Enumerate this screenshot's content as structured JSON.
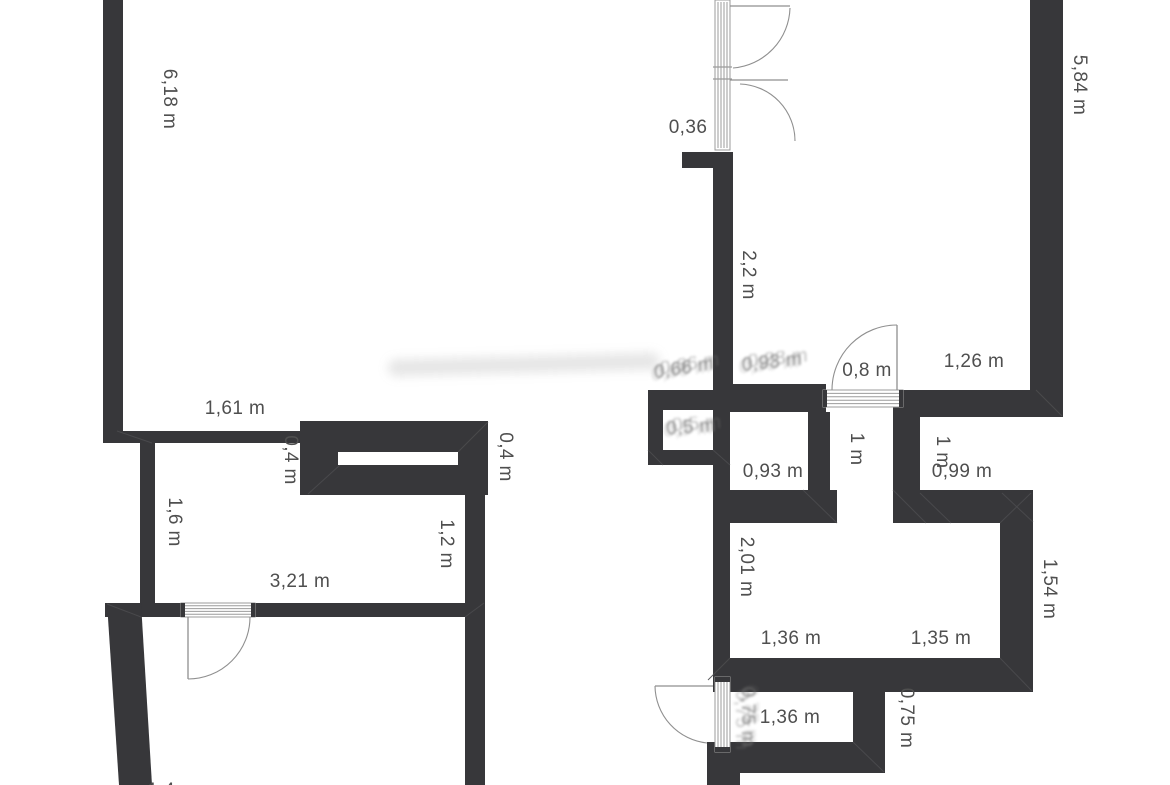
{
  "page": {
    "description": "Black-and-white architectural floor plan with dimension annotations",
    "units": "m"
  },
  "colors": {
    "background": "#ffffff",
    "wall": "#37373a",
    "label": "#4f4f4f",
    "door_line": "#8f8f8f",
    "threshold_stripe": "#9b9b9b",
    "mitre_line": "#4b4b4e"
  },
  "dimension_labels": [
    {
      "text": "6,18 m",
      "x": 169,
      "y": 99,
      "rotated": true,
      "ghost": false,
      "tilt": 0
    },
    {
      "text": "5,84 m",
      "x": 1079,
      "y": 85,
      "rotated": true,
      "ghost": false,
      "tilt": 0
    },
    {
      "text": "0,36",
      "x": 688,
      "y": 128,
      "rotated": false,
      "ghost": false,
      "tilt": 0
    },
    {
      "text": "2,2 m",
      "x": 748,
      "y": 275,
      "rotated": true,
      "ghost": false,
      "tilt": 0
    },
    {
      "text": "0,8 m",
      "x": 867,
      "y": 371,
      "rotated": false,
      "ghost": false,
      "tilt": 0
    },
    {
      "text": "1,26 m",
      "x": 974,
      "y": 362,
      "rotated": false,
      "ghost": false,
      "tilt": 0
    },
    {
      "text": "1,61 m",
      "x": 235,
      "y": 409,
      "rotated": false,
      "ghost": false,
      "tilt": 0
    },
    {
      "text": "0,4 m",
      "x": 290,
      "y": 460,
      "rotated": true,
      "ghost": false,
      "tilt": 0
    },
    {
      "text": "0,4 m",
      "x": 505,
      "y": 457,
      "rotated": true,
      "ghost": false,
      "tilt": 0
    },
    {
      "text": "1,6 m",
      "x": 174,
      "y": 522,
      "rotated": true,
      "ghost": false,
      "tilt": 0
    },
    {
      "text": "1,2 m",
      "x": 446,
      "y": 544,
      "rotated": true,
      "ghost": false,
      "tilt": 0
    },
    {
      "text": "3,21 m",
      "x": 300,
      "y": 582,
      "rotated": false,
      "ghost": false,
      "tilt": 0
    },
    {
      "text": "0,93 m",
      "x": 773,
      "y": 472,
      "rotated": false,
      "ghost": false,
      "tilt": 0
    },
    {
      "text": "1 m",
      "x": 856,
      "y": 449,
      "rotated": true,
      "ghost": false,
      "tilt": 0
    },
    {
      "text": "1 m",
      "x": 942,
      "y": 452,
      "rotated": true,
      "ghost": false,
      "tilt": 0
    },
    {
      "text": "0,99 m",
      "x": 962,
      "y": 472,
      "rotated": false,
      "ghost": false,
      "tilt": 0
    },
    {
      "text": "2,01 m",
      "x": 746,
      "y": 567,
      "rotated": true,
      "ghost": false,
      "tilt": 0
    },
    {
      "text": "1,54 m",
      "x": 1049,
      "y": 589,
      "rotated": true,
      "ghost": false,
      "tilt": 0
    },
    {
      "text": "1,36 m",
      "x": 791,
      "y": 639,
      "rotated": false,
      "ghost": false,
      "tilt": 0
    },
    {
      "text": "1,35 m",
      "x": 941,
      "y": 639,
      "rotated": false,
      "ghost": false,
      "tilt": 0
    },
    {
      "text": "1,36 m",
      "x": 790,
      "y": 718,
      "rotated": false,
      "ghost": false,
      "tilt": 0
    },
    {
      "text": "0,75 m",
      "x": 906,
      "y": 718,
      "rotated": true,
      "ghost": false,
      "tilt": 0
    },
    {
      "text": "0,66 m",
      "x": 684,
      "y": 369,
      "rotated": false,
      "ghost": true,
      "tilt": 1
    },
    {
      "text": "0,93 m",
      "x": 772,
      "y": 363,
      "rotated": false,
      "ghost": true,
      "tilt": 2
    },
    {
      "text": "0,5 m",
      "x": 691,
      "y": 428,
      "rotated": false,
      "ghost": true,
      "tilt": 3
    },
    {
      "text": "0,75 m",
      "x": 747,
      "y": 717,
      "rotated": true,
      "ghost": true,
      "tilt": 0
    },
    {
      "text": "1,4 m",
      "x": 172,
      "y": 791,
      "rotated": false,
      "ghost": false,
      "tilt": 0
    }
  ],
  "walls": [
    {
      "name": "left-wall-top",
      "x": 103,
      "y": 0,
      "w": 20,
      "h": 432
    },
    {
      "name": "small-room-top-wall",
      "x": 103,
      "y": 431,
      "w": 217,
      "h": 12
    },
    {
      "name": "shelf-block",
      "x": 300,
      "y": 421,
      "w": 188,
      "h": 74
    },
    {
      "name": "small-room-left-wall",
      "x": 140,
      "y": 443,
      "w": 15,
      "h": 174
    },
    {
      "name": "small-room-bottom-left",
      "x": 105,
      "y": 603,
      "w": 76,
      "h": 14
    },
    {
      "name": "small-room-bottom-right",
      "x": 255,
      "y": 603,
      "w": 211,
      "h": 14
    },
    {
      "name": "left-section-right-wall",
      "x": 465,
      "y": 495,
      "w": 20,
      "h": 290
    },
    {
      "name": "top-door-stub-wall",
      "x": 682,
      "y": 152,
      "w": 51,
      "h": 16
    },
    {
      "name": "hall-wall-2-2",
      "x": 713,
      "y": 152,
      "w": 20,
      "h": 240
    },
    {
      "name": "mid-band-left",
      "x": 648,
      "y": 390,
      "w": 65,
      "h": 20
    },
    {
      "name": "mid-band-right",
      "x": 713,
      "y": 384,
      "w": 113,
      "h": 28
    },
    {
      "name": "alcove-left-wall",
      "x": 648,
      "y": 390,
      "w": 15,
      "h": 75
    },
    {
      "name": "alcove-bottom-wall",
      "x": 648,
      "y": 450,
      "w": 82,
      "h": 15
    },
    {
      "name": "room093-left-wall",
      "x": 713,
      "y": 408,
      "w": 17,
      "h": 115
    },
    {
      "name": "room093-right-wall",
      "x": 808,
      "y": 412,
      "w": 22,
      "h": 82
    },
    {
      "name": "bottomroom-top-left-wall",
      "x": 713,
      "y": 490,
      "w": 124,
      "h": 33
    },
    {
      "name": "corridor1m-right-wall",
      "x": 893,
      "y": 407,
      "w": 27,
      "h": 116
    },
    {
      "name": "bottomroom-top-right-wall",
      "x": 893,
      "y": 490,
      "w": 140,
      "h": 33
    },
    {
      "name": "top-wall-right-of-door",
      "x": 903,
      "y": 390,
      "w": 160,
      "h": 27
    },
    {
      "name": "building-right-wall",
      "x": 1030,
      "y": 0,
      "w": 33,
      "h": 417
    },
    {
      "name": "room154-right-wall",
      "x": 1000,
      "y": 523,
      "w": 33,
      "h": 169
    },
    {
      "name": "bottomroom-bottom-wall",
      "x": 713,
      "y": 658,
      "w": 320,
      "h": 34
    },
    {
      "name": "bottomroom-left-wall",
      "x": 713,
      "y": 523,
      "w": 17,
      "h": 135
    },
    {
      "name": "below-threshold-wall",
      "x": 707,
      "y": 742,
      "w": 33,
      "h": 43
    },
    {
      "name": "exit-corridor-bottom-wall",
      "x": 740,
      "y": 742,
      "w": 145,
      "h": 31
    },
    {
      "name": "exit-corridor-right-wall",
      "x": 853,
      "y": 692,
      "w": 32,
      "h": 81
    }
  ],
  "wall_polygons": [
    {
      "name": "outer-angled-wall",
      "points": "107,603 141,603 152,785 119,785"
    }
  ],
  "shelf_slot": {
    "name": "shelf-slot",
    "x": 338,
    "y": 452,
    "w": 120,
    "h": 13
  },
  "doors": [
    {
      "name": "entry-door-upper",
      "leaf": "M730,6 H790",
      "arc": "M790,8 A62,62 0 0 1 733,68"
    },
    {
      "name": "entry-door-lower",
      "leaf": "M730,80 H788",
      "arc": "M740,84 A57,57 0 0 1 795,141"
    },
    {
      "name": "door-0-8",
      "leaf": "M897,325 V390",
      "arc": "M897,325 A65,65 0 0 0 832,390"
    },
    {
      "name": "small-room-door",
      "leaf": "M188,617 V679",
      "arc": "M250,617 A62,62 0 0 1 188,679"
    },
    {
      "name": "exit-door",
      "leaf": "M655,686 H713",
      "arc": "M655,686 A58,58 0 0 0 707,743"
    }
  ],
  "thresholds": [
    {
      "name": "entry-door-frame",
      "x": 715,
      "y": 0,
      "w": 15,
      "h": 150,
      "orientation": "vertical",
      "caps": false,
      "dividers": [
        67,
        79
      ]
    },
    {
      "name": "door-0-8-threshold",
      "x": 823,
      "y": 390,
      "w": 80,
      "h": 17,
      "orientation": "horizontal",
      "caps": true,
      "dividers": []
    },
    {
      "name": "small-room-threshold",
      "x": 181,
      "y": 603,
      "w": 74,
      "h": 14,
      "orientation": "horizontal",
      "caps": true,
      "dividers": []
    },
    {
      "name": "exit-door-threshold",
      "x": 715,
      "y": 677,
      "w": 15,
      "h": 75,
      "orientation": "vertical",
      "caps": true,
      "dividers": []
    }
  ],
  "mitre_lines": [
    {
      "x1": 117,
      "y1": 431,
      "x2": 152,
      "y2": 443
    },
    {
      "x1": 488,
      "y1": 422,
      "x2": 458,
      "y2": 452
    },
    {
      "x1": 308,
      "y1": 494,
      "x2": 340,
      "y2": 465
    },
    {
      "x1": 107,
      "y1": 604,
      "x2": 141,
      "y2": 617
    },
    {
      "x1": 465,
      "y1": 617,
      "x2": 484,
      "y2": 603
    },
    {
      "x1": 803,
      "y1": 490,
      "x2": 837,
      "y2": 523
    },
    {
      "x1": 893,
      "y1": 490,
      "x2": 926,
      "y2": 523
    },
    {
      "x1": 730,
      "y1": 658,
      "x2": 708,
      "y2": 680
    },
    {
      "x1": 1000,
      "y1": 658,
      "x2": 1032,
      "y2": 691
    },
    {
      "x1": 1036,
      "y1": 390,
      "x2": 1062,
      "y2": 416
    },
    {
      "x1": 920,
      "y1": 493,
      "x2": 951,
      "y2": 523
    },
    {
      "x1": 1002,
      "y1": 493,
      "x2": 1033,
      "y2": 522
    },
    {
      "x1": 853,
      "y1": 742,
      "x2": 884,
      "y2": 772
    },
    {
      "x1": 713,
      "y1": 450,
      "x2": 730,
      "y2": 465
    },
    {
      "x1": 648,
      "y1": 450,
      "x2": 663,
      "y2": 465
    },
    {
      "x1": 1000,
      "y1": 523,
      "x2": 1031,
      "y2": 493
    }
  ],
  "smears": [
    {
      "x": 388,
      "y": 356,
      "w": 272,
      "h": 17
    }
  ]
}
